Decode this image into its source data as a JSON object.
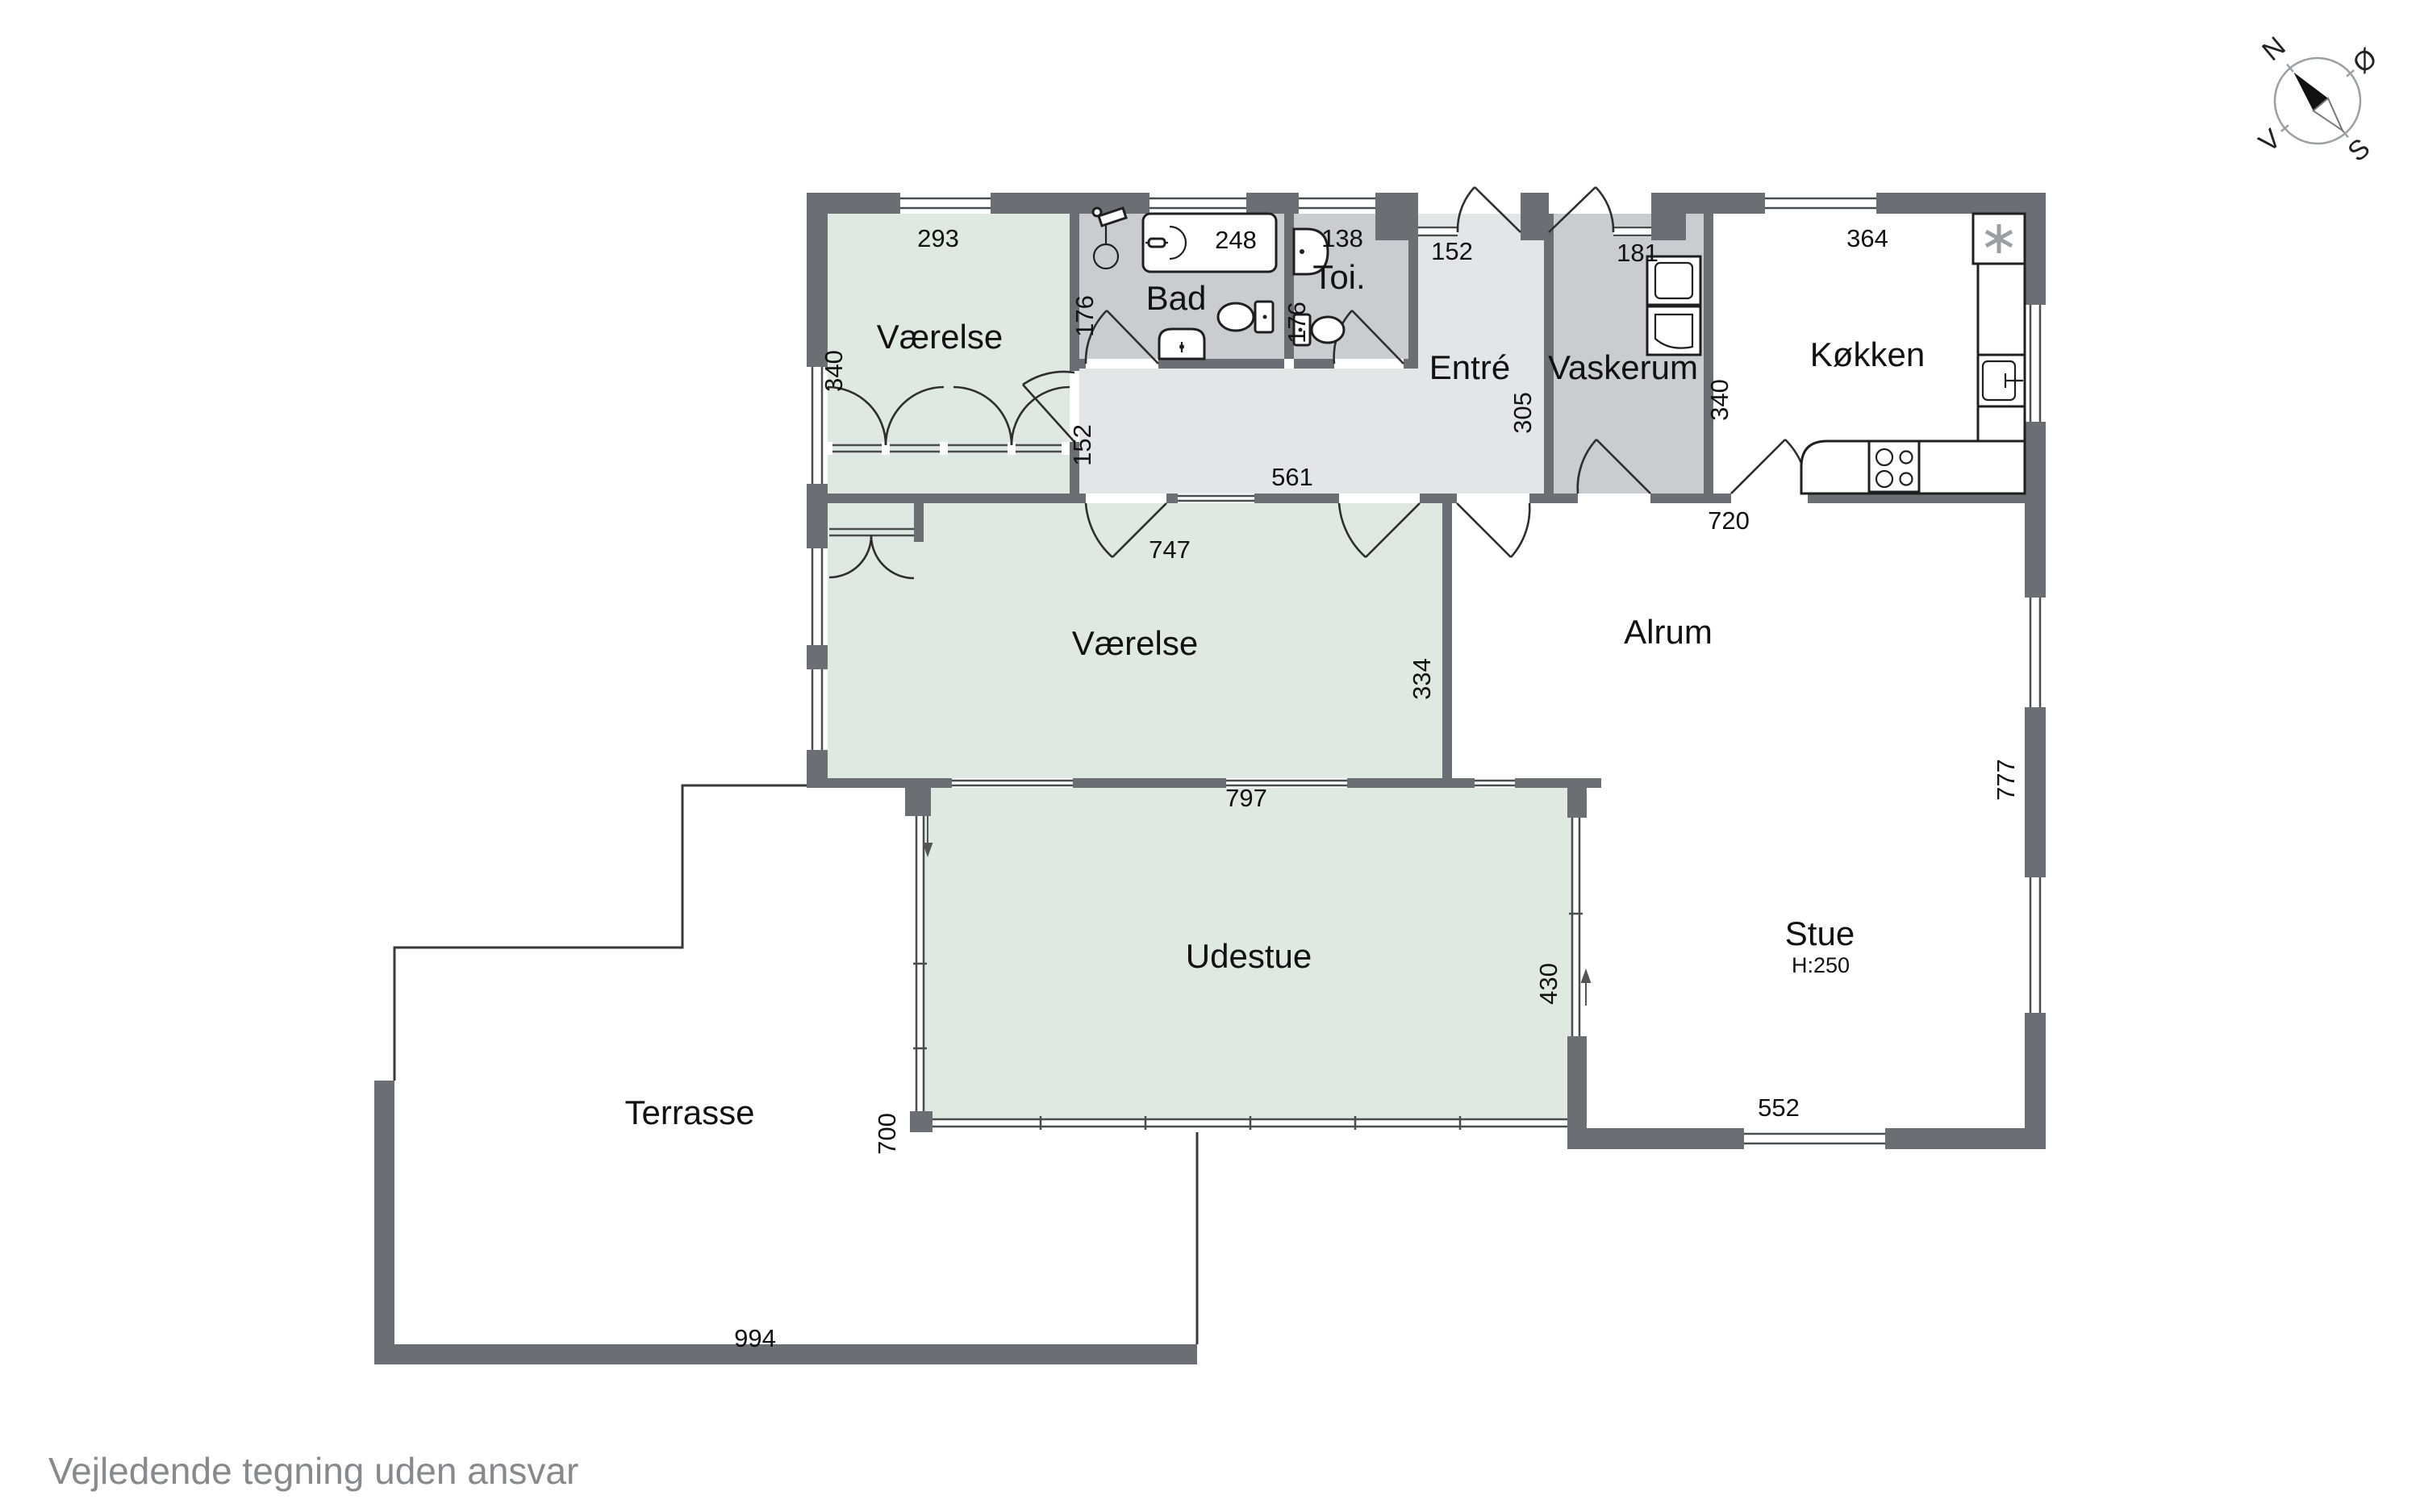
{
  "disclaimer": "Vejledende tegning uden ansvar",
  "compass": {
    "north": "N",
    "east": "Ø",
    "south": "S",
    "west": "V"
  },
  "rooms": {
    "bedroom1": {
      "label": "Værelse"
    },
    "bathroom": {
      "label": "Bad"
    },
    "toilet": {
      "label": "Toi."
    },
    "entry": {
      "label": "Entré"
    },
    "laundry": {
      "label": "Vaskerum"
    },
    "kitchen": {
      "label": "Køkken"
    },
    "bedroom2": {
      "label": "Værelse"
    },
    "familyroom": {
      "label": "Alrum"
    },
    "livingroom": {
      "label": "Stue",
      "ceiling_height": "H:250"
    },
    "sunroom": {
      "label": "Udestue"
    },
    "terrace": {
      "label": "Terrasse"
    }
  },
  "dimensions_cm": {
    "bedroom1_width": "293",
    "bedroom1_depth": "340",
    "bathtub_width": "248",
    "bathroom_depth": "176",
    "toilet_width": "138",
    "toilet_depth": "176",
    "entry_width": "152",
    "entry_depth": "305",
    "laundry_width": "181",
    "kitchen_width": "364",
    "kitchen_depth": "340",
    "kitchen_south": "720",
    "hall_width": "152",
    "hall_length": "561",
    "bedroom2_width": "747",
    "bedroom2_depth": "334",
    "east_wall": "777",
    "livingroom_south": "552",
    "sunroom_width": "797",
    "sunroom_depth": "430",
    "sunroom_west": "700",
    "terrace_width": "994"
  }
}
